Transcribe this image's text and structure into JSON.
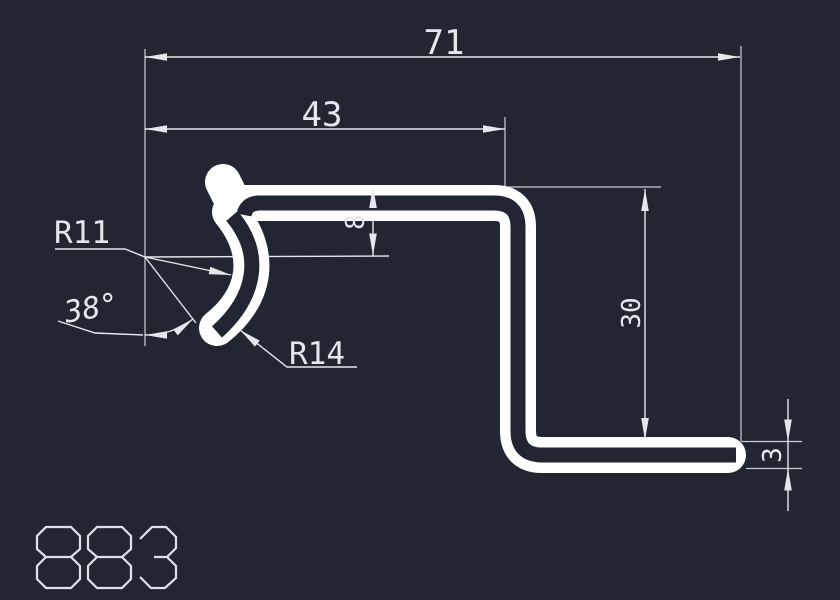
{
  "canvas": {
    "width": 840,
    "height": 600,
    "background_color": "#212632",
    "profile_color": "#ffffff",
    "dimension_line_color": "#e4e8ee",
    "extension_line_color": "#c9cfd9",
    "text_color": "#e4e8ee"
  },
  "drawing_type": "profile-cross-section",
  "labels": {
    "overall_width": "71",
    "upper_width": "43",
    "offset_depth": "8",
    "leg_height": "30",
    "thickness": "3",
    "radius_small": "R11",
    "radius_large": "R14",
    "bend_angle": "38°",
    "part_number": "883"
  }
}
